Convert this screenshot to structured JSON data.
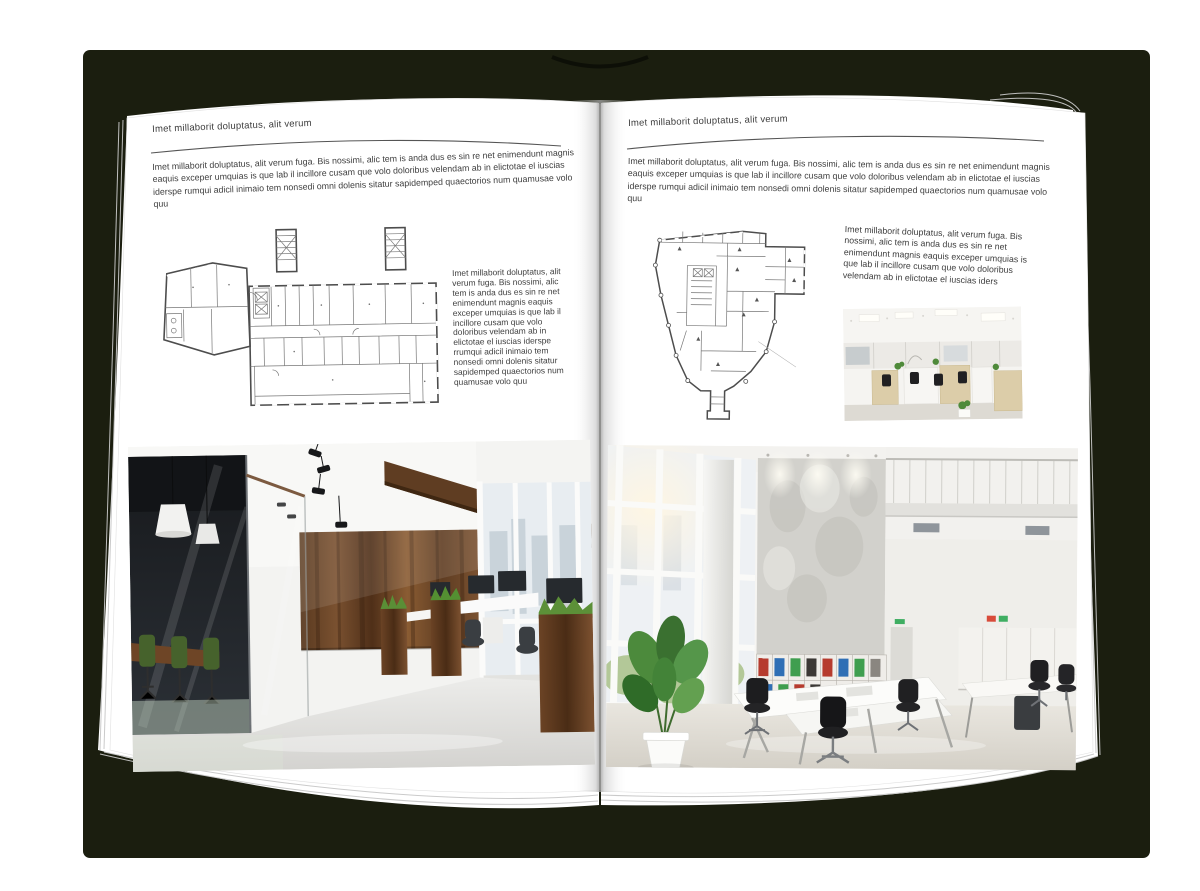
{
  "left_page": {
    "header": "Imet millaborit doluptatus, alit verum",
    "intro": "Imet millaborit doluptatus, alit verum fuga. Bis nossimi, alic tem is anda dus es sin re net enimendunt magnis eaquis exceper umquias is que lab il incillore cusam que volo doloribus velendam ab in elictotae el iuscias iderspe rumqui adicil inimaio tem nonsedi omni dolenis sitatur sapidemped quaectorios num quamusae volo quu",
    "caption": "Imet millaborit doluptatus, alit verum fuga. Bis nossimi, alic tem is anda dus es sin re net enimendunt magnis eaquis exceper umquias is que lab il incillore cusam que volo doloribus velendam ab in elictotae el iuscias iderspe rrumqui adicil inimaio tem nonsedi omni dolenis sitatur sapidemped quaectorios num quamusae volo quu"
  },
  "right_page": {
    "header": "Imet millaborit doluptatus, alit verum",
    "intro": "Imet millaborit doluptatus, alit verum fuga. Bis nossimi, alic tem is anda dus es sin re net enimendunt magnis eaquis exceper umquias is que lab il incillore cusam que volo doloribus velendam ab in elictotae el iuscias iderspe rumqui adicil inimaio tem nonsedi omni dolenis sitatur sapidemped quaectorios num quamusae volo quu",
    "caption": "Imet millaborit doluptatus, alit verum fuga. Bis nossimi, alic tem is anda dus es sin re net enimendunt magnis eaquis exceper umquias is que lab il incillore cusam que volo doloribus velendam ab in elictotae el iuscias iders"
  },
  "images": {
    "left_floor_plan": "architectural-floor-plan-drawing",
    "right_floor_plan": "architectural-floor-plan-drawing",
    "left_photo": "modern-office-interior-photo",
    "right_photo": "bright-office-hall-photo",
    "right_small_photo": "open-space-office-photo"
  },
  "colors": {
    "cover": "#1b1e0f",
    "page": "#ffffff",
    "text": "#3e3e3e",
    "wood": "#6e4526",
    "chair_green": "#46622c",
    "binder_red": "#b63b2e",
    "binder_blue": "#2f6fb5",
    "binder_green": "#3f9e4f"
  }
}
